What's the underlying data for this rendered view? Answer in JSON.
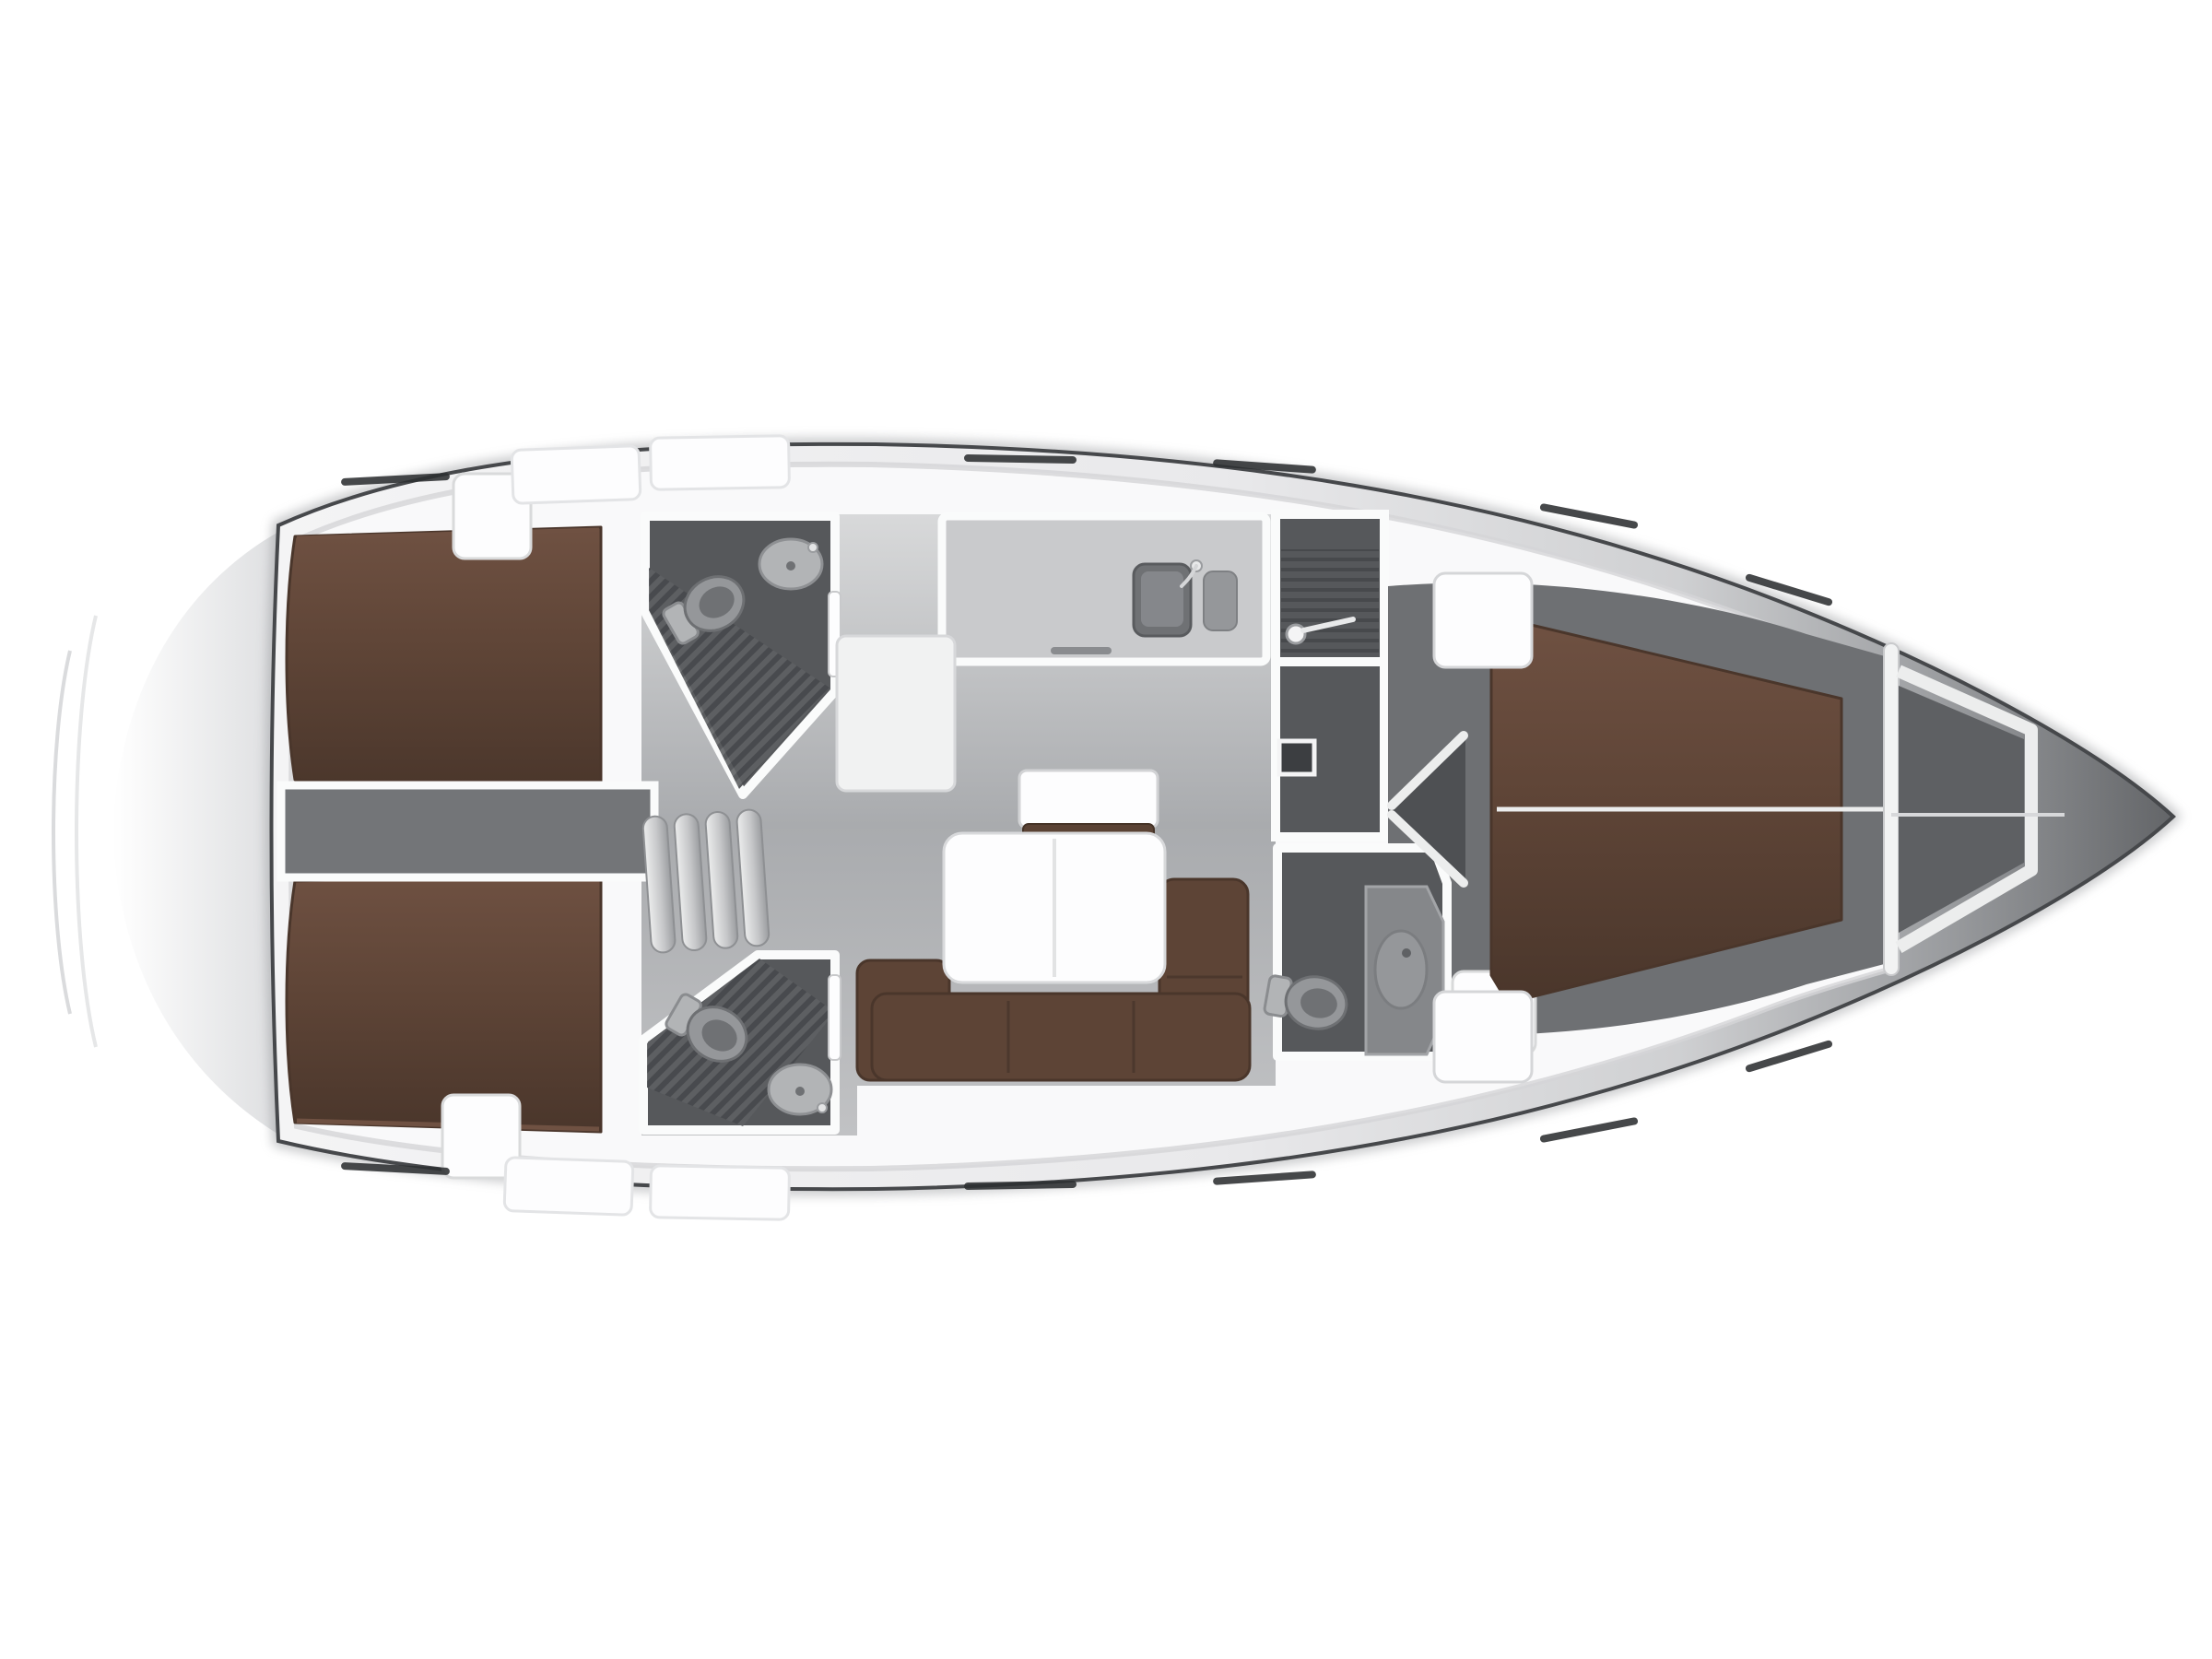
{
  "figure": {
    "kind": "yacht-interior-floor-plan",
    "view": "top-down",
    "orientation": "bow-right-stern-left",
    "background": "#ffffff"
  },
  "palette": {
    "hull_line": "#46484b",
    "hull_light": "#f4f4f5",
    "hull_mid": "#e9e9eb",
    "hull_soft": "#cfd0d2",
    "hull_shadow": "#9a9c9f",
    "hull_dark": "#636568",
    "hull_halo": "#8f9194",
    "deck": "#f9f9fa",
    "deck_rim": "#d4d5d7",
    "stern_shade": "#dcdddf",
    "salon_floor_light": "#d8d9da",
    "salon_floor_mid": "#a9abae",
    "salon_floor_low": "#c1c2c4",
    "head_floor": "#56585b",
    "grate_dark": "#47494c",
    "grate_light": "#5e6063",
    "engine_floor": "#737578",
    "fwd_floor": "#6e7073",
    "bow_locker": "#5e6063",
    "bed_brown": "#5f4537",
    "bed_brown_dark": "#4a362b",
    "bed_brown_light": "#6f5142",
    "sofa_brown": "#5d4436",
    "sideboard_front": "#5a4234",
    "furniture_white": "#fdfdfe",
    "furniture_stroke": "#d5d6d8",
    "fixture_light": "#b2b4b6",
    "fixture_mid": "#95979a",
    "fixture_dark": "#6f7174",
    "fixture_edge": "#8e9093",
    "step_light": "#eceded",
    "step_dark": "#9b9da0",
    "wall_white": "#fafbfb",
    "window_dash": "#2d2f31",
    "seam_white": "#eceded"
  },
  "rooms": [
    {
      "id": "aft-cabin-port",
      "label": "Aft double cabin (port)"
    },
    {
      "id": "aft-cabin-starboard",
      "label": "Aft double cabin (starboard)"
    },
    {
      "id": "engine-corridor",
      "label": "Engine compartment under companionway"
    },
    {
      "id": "companionway",
      "label": "Companionway steps"
    },
    {
      "id": "aft-head-port",
      "label": "Aft head with shower (port)"
    },
    {
      "id": "aft-head-starboard",
      "label": "Aft head with shower (starboard)"
    },
    {
      "id": "galley",
      "label": "L-shaped galley"
    },
    {
      "id": "salon",
      "label": "Salon with U-sofa and folding table"
    },
    {
      "id": "mid-head",
      "label": "Forward shower room"
    },
    {
      "id": "fwd-head",
      "label": "Forward head"
    },
    {
      "id": "fwd-cabin",
      "label": "Forward V-berth cabin"
    },
    {
      "id": "anchor-locker",
      "label": "Bow anchor locker"
    }
  ],
  "furniture": [
    {
      "id": "berth-port",
      "label": "double berth",
      "room": "aft-cabin-port"
    },
    {
      "id": "berth-starboard",
      "label": "double berth",
      "room": "aft-cabin-starboard"
    },
    {
      "id": "v-berth",
      "label": "V-shaped double berth",
      "room": "fwd-cabin"
    },
    {
      "id": "sofa",
      "label": "U-shaped settee",
      "room": "salon"
    },
    {
      "id": "table",
      "label": "folding salon table",
      "room": "salon"
    },
    {
      "id": "sideboard",
      "label": "sideboard cabinet",
      "room": "salon"
    },
    {
      "id": "galley-sink",
      "label": "sink with faucet",
      "room": "galley"
    },
    {
      "id": "toilets",
      "label": "marine toilet x3"
    },
    {
      "id": "washbasins",
      "label": "washbasin x3"
    },
    {
      "id": "shower-head",
      "label": "shower fitting",
      "room": "mid-head"
    },
    {
      "id": "wardrobe-doors",
      "label": "double cabin doors",
      "room": "fwd-cabin"
    }
  ]
}
